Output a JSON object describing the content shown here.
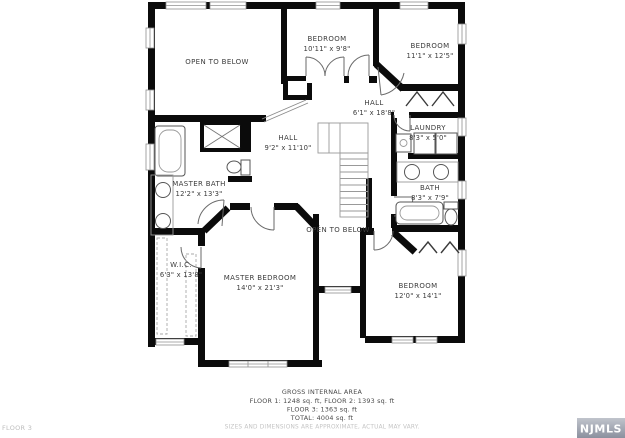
{
  "watermark": {
    "floor_label": "FLOOR 3",
    "logo_text": "NJMLS",
    "logo_bg_top": "#c0c4cc",
    "logo_bg_bottom": "#8b909e",
    "logo_text_color": "#ffffff"
  },
  "footer": {
    "title": "GROSS INTERNAL AREA",
    "line1": "FLOOR 1: 1248 sq. ft, FLOOR 2: 1393 sq. ft",
    "line2": "FLOOR 3: 1363 sq. ft",
    "line3": "TOTAL: 4004 sq. ft",
    "disclaimer": "SIZES AND DIMENSIONS ARE APPROXIMATE, ACTUAL MAY VARY."
  },
  "rooms": {
    "open_to_below_top": {
      "name": "OPEN TO BELOW"
    },
    "open_to_below_middle": {
      "name": "OPEN TO BELOW"
    },
    "bedroom_top": {
      "name": "BEDROOM",
      "dims": "10'11\" x 9'8\""
    },
    "bedroom_right": {
      "name": "BEDROOM",
      "dims": "11'1\" x 12'5\""
    },
    "hall_upper": {
      "name": "HALL",
      "dims": "6'1\" x 18'8\""
    },
    "laundry": {
      "name": "LAUNDRY",
      "dims": "8'3\" x 5'0\""
    },
    "hall_center": {
      "name": "HALL",
      "dims": "9'2\" x 11'10\""
    },
    "master_bath": {
      "name": "MASTER BATH",
      "dims": "12'2\" x 13'3\""
    },
    "bath": {
      "name": "BATH",
      "dims": "8'3\" x 7'9\""
    },
    "wic": {
      "name": "W.I.C.",
      "dims": "6'3\" x 13'8\""
    },
    "master_bedroom": {
      "name": "MASTER BEDROOM",
      "dims": "14'0\" x 21'3\""
    },
    "bedroom_bottom": {
      "name": "BEDROOM",
      "dims": "12'0\" x 14'1\""
    }
  },
  "colors": {
    "wall": "#0b0b0b",
    "background": "#ffffff",
    "label": "#3c3c3c",
    "muted": "#c4c4c4"
  }
}
